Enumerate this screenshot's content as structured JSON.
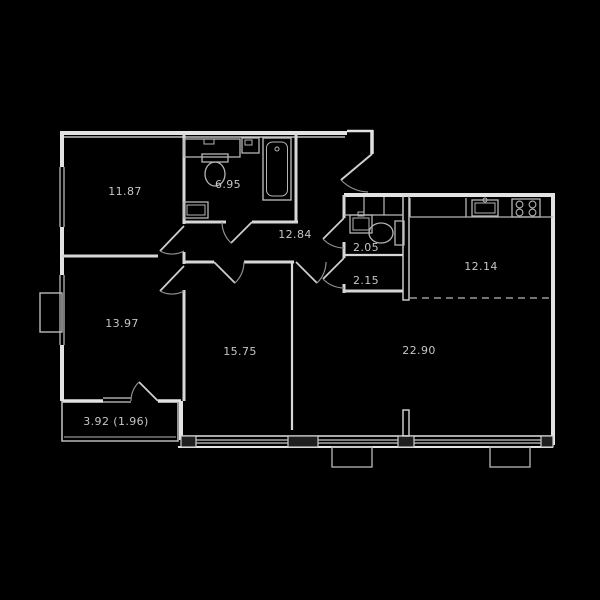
{
  "plan": {
    "type": "apartment-floor-plan",
    "background": "#000000",
    "wall_color": "#e3e3e3",
    "fixture_color": "#b5b5b5",
    "label_color": "#c6c6c6",
    "rooms": {
      "bedroom_top_left": {
        "label": "11.87"
      },
      "bathroom": {
        "label": "6.95"
      },
      "hallway": {
        "label": "12.84"
      },
      "wc": {
        "label": "2.05"
      },
      "storage": {
        "label": "2.15"
      },
      "kitchen": {
        "label": "12.14"
      },
      "bedroom_bottom_left": {
        "label": "13.97"
      },
      "room_center": {
        "label": "15.75"
      },
      "living_room": {
        "label": "22.90"
      },
      "balcony": {
        "label": "3.92 (1.96)"
      }
    },
    "fixtures": [
      "toilet",
      "vanity-sink",
      "bathtub",
      "washing-machine",
      "shower-tray",
      "wc-sink",
      "wc-toilet",
      "kitchen-counter",
      "kitchen-sink",
      "stove-4-burner"
    ],
    "features": [
      "entrance-door-arc",
      "balcony-glazing",
      "window-bottom-left",
      "window-center",
      "window-right",
      "dashed-kitchen-boundary",
      "exterior-duct-box"
    ]
  }
}
